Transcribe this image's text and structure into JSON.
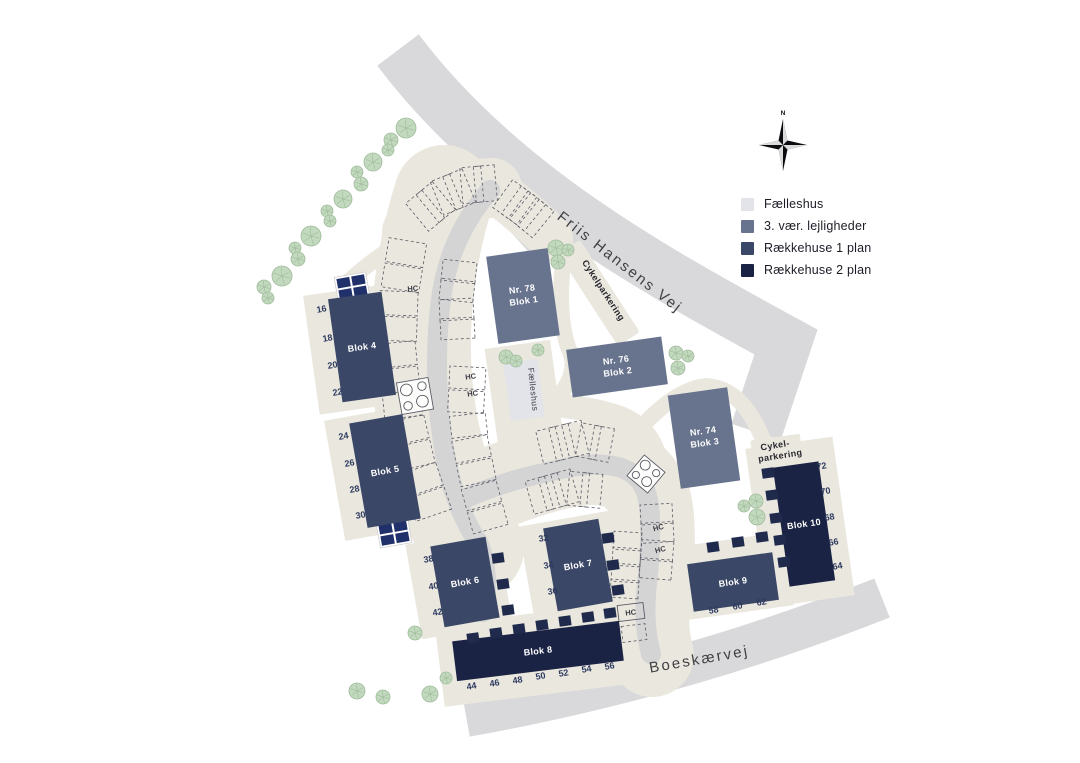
{
  "legend": {
    "items": [
      {
        "label": "Fælleshus",
        "color": "#e2e4ea",
        "type": "community"
      },
      {
        "label": "3. vær. lejligheder",
        "color": "#68748e",
        "type": "apartments"
      },
      {
        "label": "Rækkehuse 1 plan",
        "color": "#3a4766",
        "type": "rowhouse-1"
      },
      {
        "label": "Rækkehuse 2 plan",
        "color": "#1b2344",
        "type": "rowhouse-2"
      }
    ]
  },
  "compass": {
    "north_label": "N"
  },
  "roads": {
    "main": "Friis Hansens Vej",
    "south": "Boeskærvej"
  },
  "site_labels": {
    "bike_parking_north": "Cykelparkering",
    "bike_parking_east_line1": "Cykel-",
    "bike_parking_east_line2": "parkering",
    "community_house": "Fælleshus",
    "handicap_spot": "HC"
  },
  "buildings": [
    {
      "id": "blok-1",
      "label": "Blok 1",
      "nr": "Nr. 78",
      "type": "apartments"
    },
    {
      "id": "blok-2",
      "label": "Blok 2",
      "nr": "Nr. 76",
      "type": "apartments"
    },
    {
      "id": "blok-3",
      "label": "Blok 3",
      "nr": "Nr. 74",
      "type": "apartments"
    },
    {
      "id": "blok-4",
      "label": "Blok 4",
      "type": "rowhouse-1",
      "house_numbers": [
        16,
        18,
        20,
        22
      ]
    },
    {
      "id": "blok-5",
      "label": "Blok 5",
      "type": "rowhouse-1",
      "house_numbers": [
        24,
        26,
        28,
        30
      ]
    },
    {
      "id": "blok-6",
      "label": "Blok 6",
      "type": "rowhouse-1",
      "house_numbers": [
        38,
        40,
        42
      ]
    },
    {
      "id": "blok-7",
      "label": "Blok 7",
      "type": "rowhouse-1",
      "house_numbers": [
        32,
        34,
        36
      ]
    },
    {
      "id": "blok-8",
      "label": "Blok 8",
      "type": "rowhouse-2",
      "house_numbers": [
        44,
        46,
        48,
        50,
        52,
        54,
        56
      ]
    },
    {
      "id": "blok-9",
      "label": "Blok 9",
      "type": "rowhouse-1",
      "house_numbers": [
        58,
        60,
        62
      ]
    },
    {
      "id": "blok-10",
      "label": "Blok 10",
      "type": "rowhouse-2",
      "house_numbers": [
        64,
        66,
        68,
        70,
        72
      ]
    }
  ],
  "type_colors": {
    "community": "#e2e4ea",
    "apartments": "#68748e",
    "rowhouse-1": "#3a4766",
    "rowhouse-2": "#1b2344"
  },
  "colors": {
    "road": "#d9d9db",
    "lane": "#d5d4d5",
    "path": "#eae7de",
    "tree_fill": "#c3d9bf",
    "tree_stroke": "#9dbb98",
    "shed": "#1f2a4d"
  },
  "icons": [
    "compass-icon",
    "tree-icon",
    "waste-station-icon",
    "bin-shelter-icon",
    "hc-parking-label"
  ]
}
